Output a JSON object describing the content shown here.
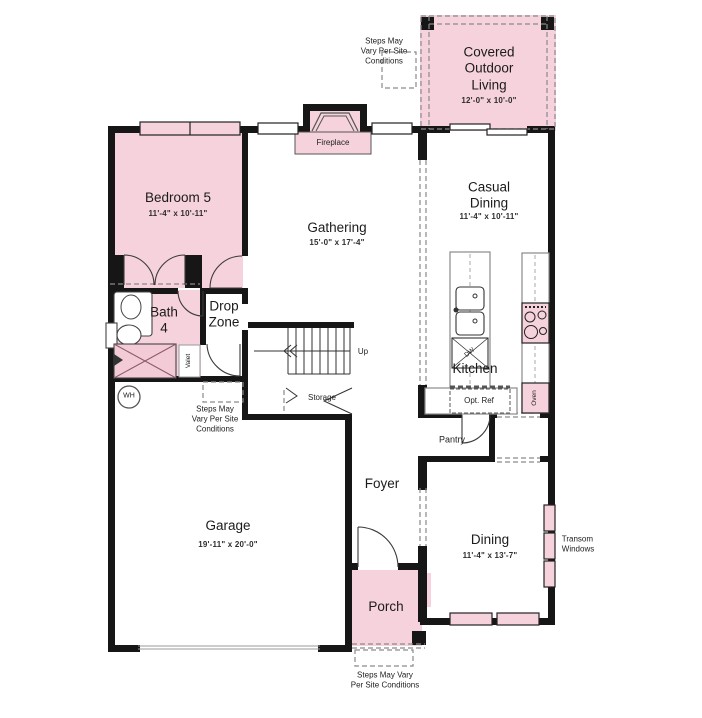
{
  "meta": {
    "type": "residential floor plan"
  },
  "colors": {
    "room_pink": "#f5d2dc",
    "wall": "#161616",
    "dash_gray": "#8a8a8a",
    "text": "#1b1b1b"
  },
  "rooms": {
    "covered_outdoor_living": {
      "label": "Covered\nOutdoor\nLiving",
      "dims": "12'-0\" x 10'-0\""
    },
    "bedroom5": {
      "label": "Bedroom 5",
      "dims": "11'-4\" x 10'-11\""
    },
    "bath4": {
      "label": "Bath\n4"
    },
    "drop_zone": {
      "label": "Drop\nZone"
    },
    "gathering": {
      "label": "Gathering",
      "dims": "15'-0\" x 17'-4\""
    },
    "casual_dining": {
      "label": "Casual\nDining",
      "dims": "11'-4\" x 10'-11\""
    },
    "kitchen": {
      "label": "Kitchen"
    },
    "pantry": {
      "label": "Pantry"
    },
    "foyer": {
      "label": "Foyer"
    },
    "dining": {
      "label": "Dining",
      "dims": "11'-4\" x 13'-7\""
    },
    "garage": {
      "label": "Garage",
      "dims": "19'-11\" x 20'-0\""
    },
    "porch": {
      "label": "Porch"
    },
    "storage": {
      "label": "Storage"
    }
  },
  "annotations": {
    "steps_top": "Steps May\nVary Per Site\nConditions",
    "steps_mid": "Steps May\nVary Per Site\nConditions",
    "steps_bottom": "Steps May Vary\nPer Site Conditions",
    "transom_windows": "Transom\nWindows",
    "fireplace": "Fireplace",
    "up": "Up",
    "valet": "Valet",
    "water_heater": "WH",
    "opt_ref": "Opt. Ref",
    "oven": "Oven",
    "dishwasher": "DW"
  }
}
